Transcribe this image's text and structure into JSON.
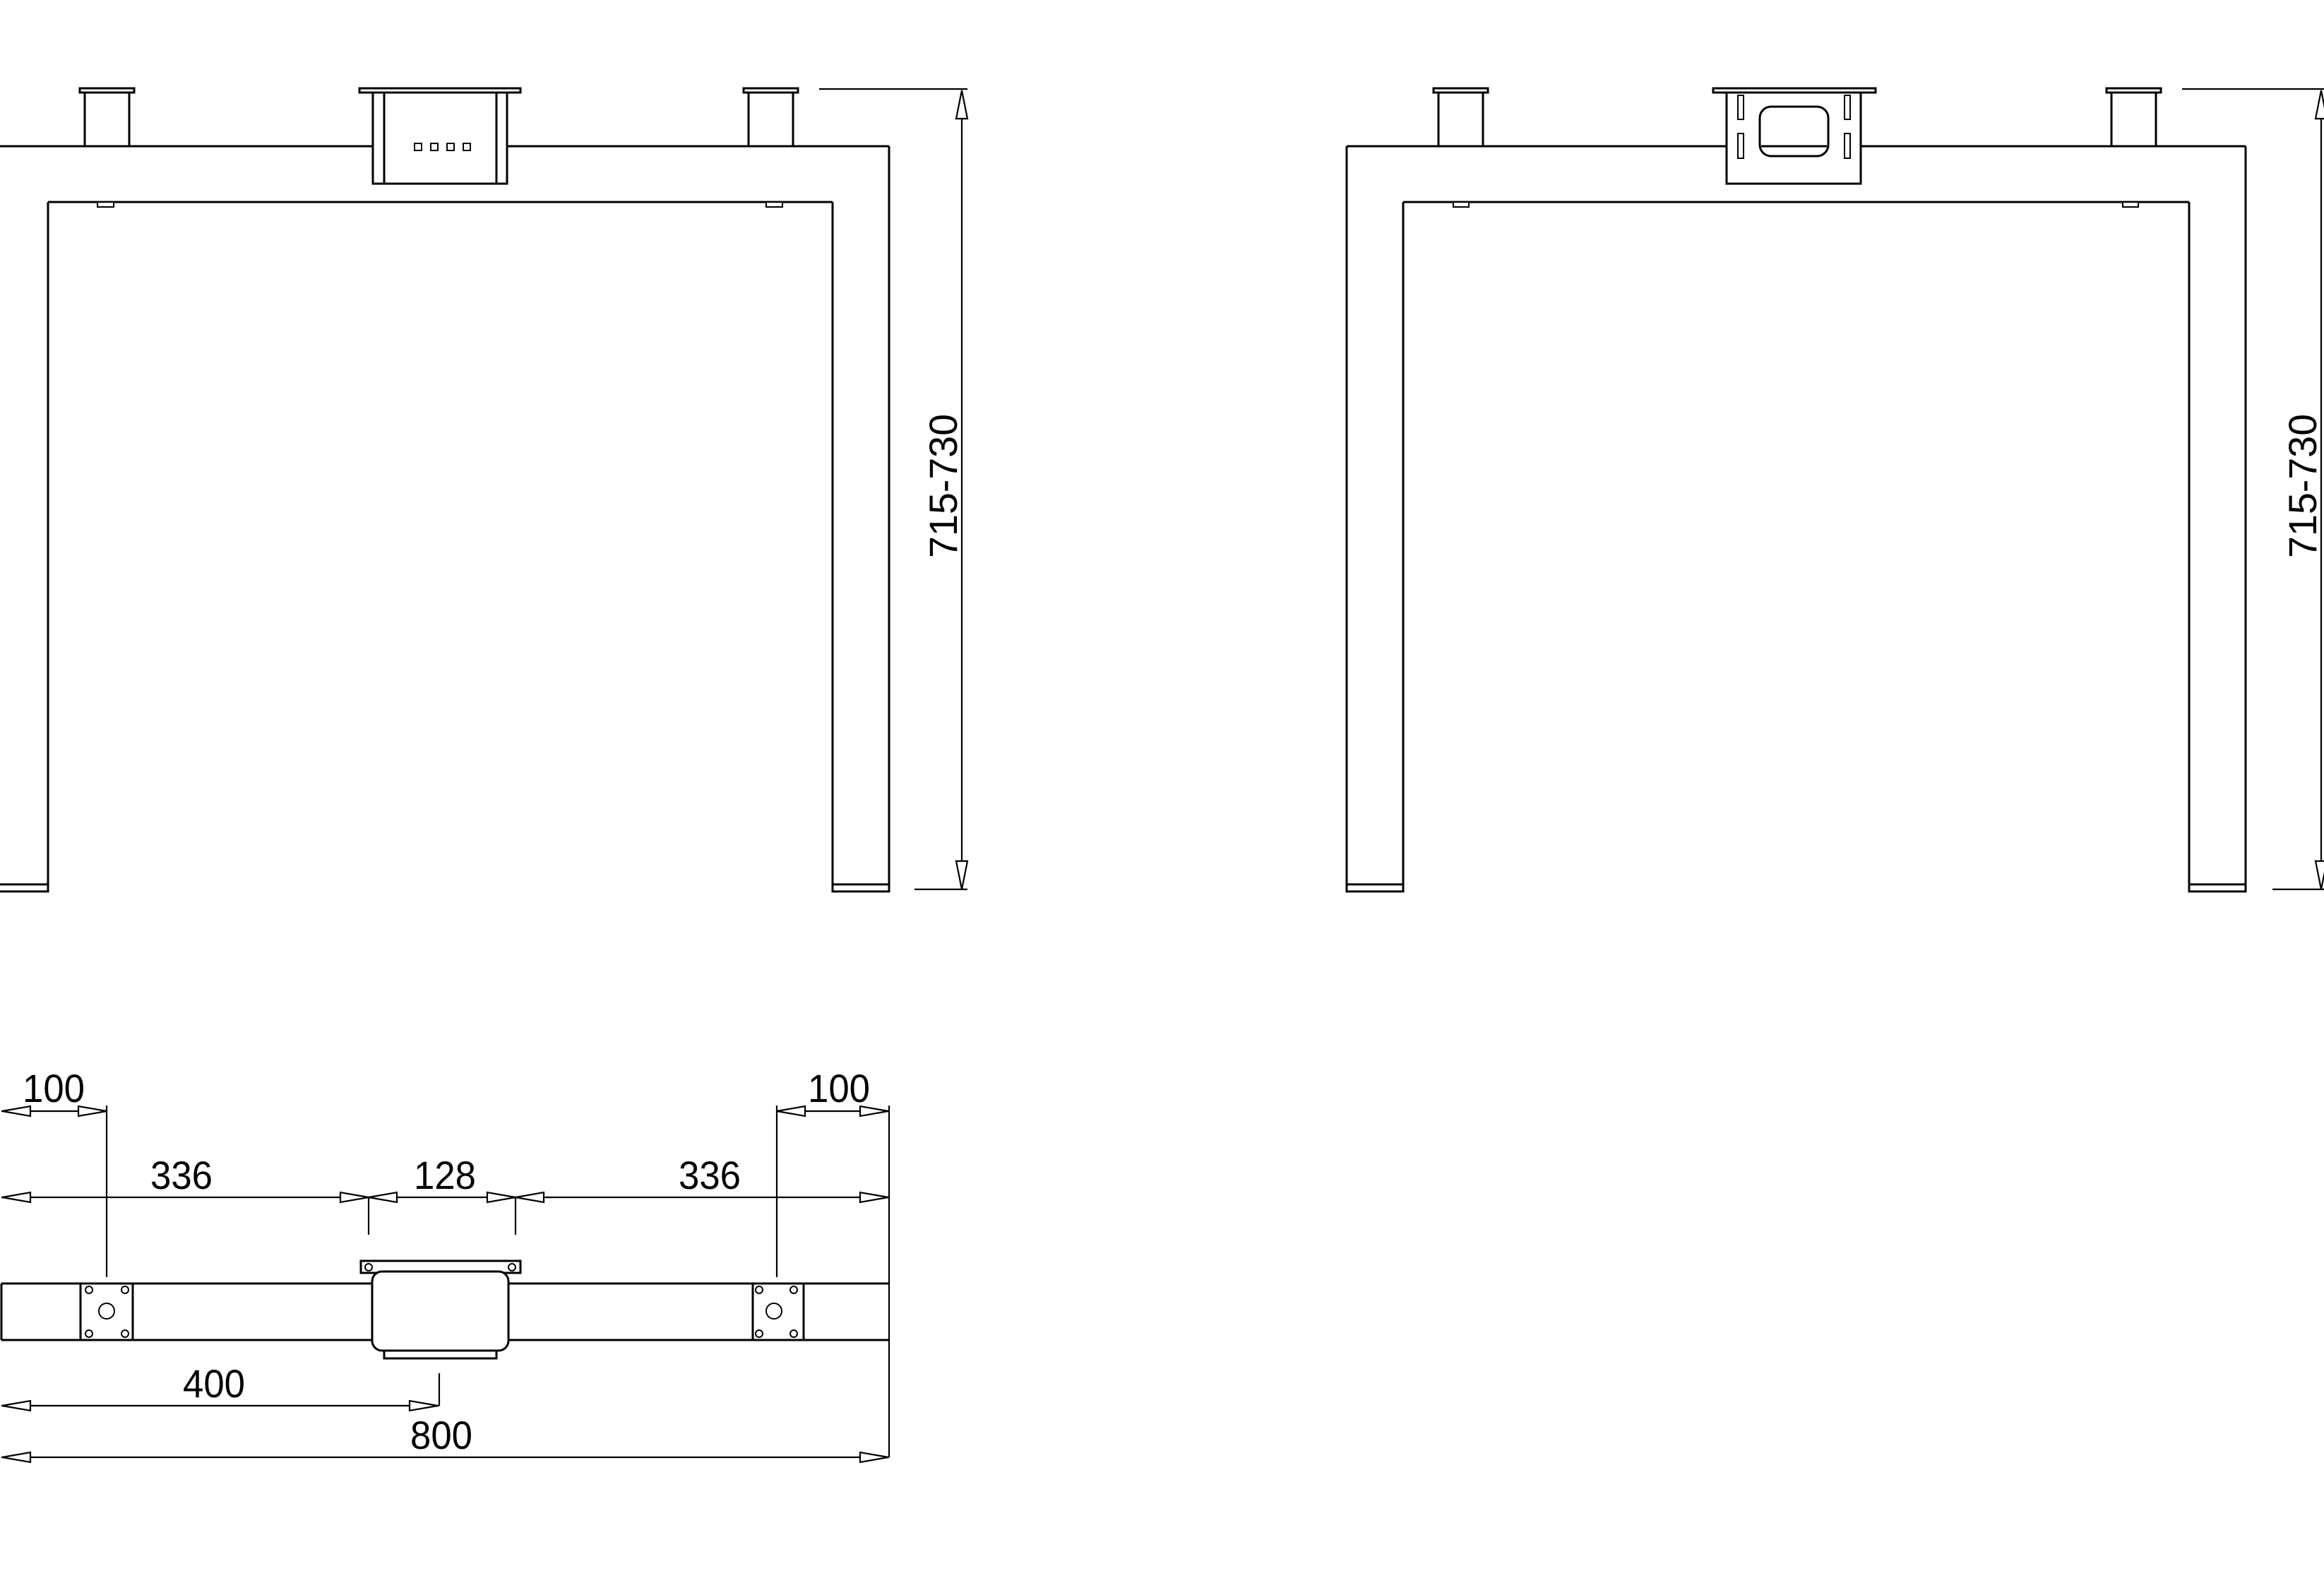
{
  "sheet": {
    "background": "#ffffff",
    "line_color": "#000000",
    "text_color": "#000000"
  },
  "views": {
    "left_front_view": {
      "height_range_label": "715-730"
    },
    "right_front_view": {
      "height_range_label": "715-730"
    },
    "crossbar_top_view": {
      "left_end_offset_label": "100",
      "right_end_offset_label": "100",
      "left_leg_to_motor_label": "336",
      "motor_hole_spacing_label": "128",
      "motor_to_right_leg_label": "336",
      "left_end_to_center_label": "400",
      "overall_length_label": "800"
    }
  }
}
